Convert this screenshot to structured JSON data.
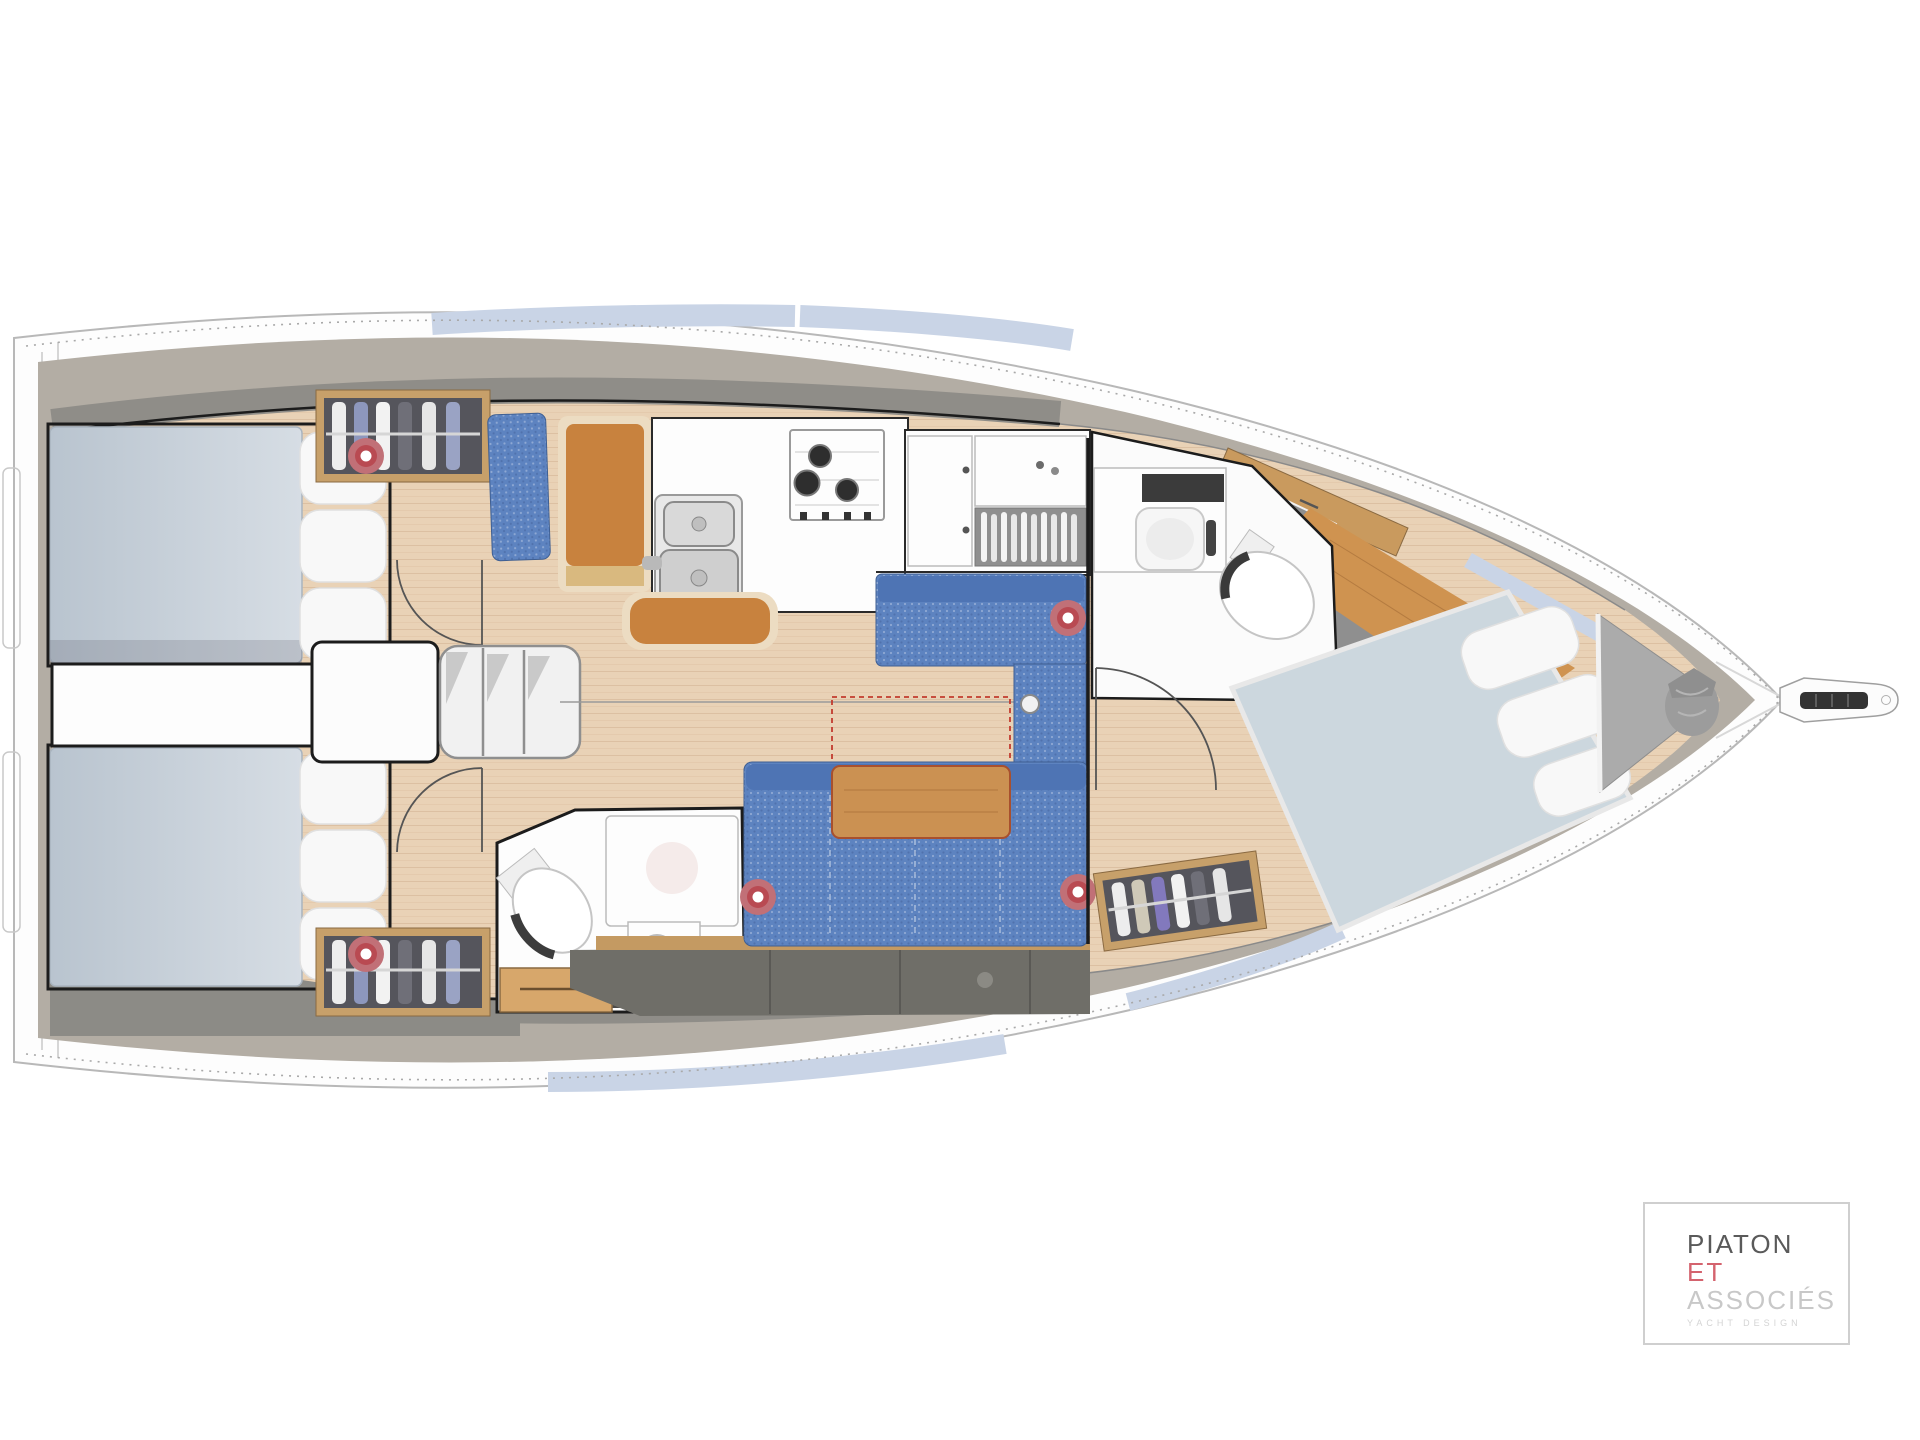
{
  "logo": {
    "name": "PIATON",
    "et": "ET",
    "associates": "ASSOCIÉS",
    "tagline": "YACHT DESIGN"
  },
  "colors": {
    "hull-stroke": "#b8b8b8",
    "deck-band": "#b3ada4",
    "deck-band-dark": "#8f8d88",
    "window-blue": "#c9d4e6",
    "wood-floor": "#e9d2b6",
    "wood-furniture": "#c8823e",
    "wood-trim": "#ecdcc2",
    "table-wood": "#cb9152",
    "fwd-mattress": "#ccd7de",
    "sofa-blue": "#5d83c0",
    "sofa-blue-dark": "#4e74b4",
    "locker-gray": "#6f6e68",
    "wardrobe-gray": "#55555c",
    "wardrobe-wood": "#c7a06a",
    "marker-red": "#b94a52",
    "line-black": "#1c1c1c",
    "anchor-gray": "#ababab",
    "logo-red": "#d4636e",
    "logo-gray": "#c8c8c8",
    "logo-dark": "#5a5a5a"
  },
  "plan": {
    "type": "sailing-yacht interior layout, top view, bow to the right",
    "features": [
      "aft double cabin port",
      "aft double cabin starboard",
      "companionway steps",
      "aft head with shower and toilet",
      "chart table with seat",
      "L-shaped galley with twin sinks and 3-burner stove",
      "saloon settees with folding table and dashed table-extension outline",
      "forward head with vanity and toilet",
      "forward owner cabin with angled island berth",
      "anchor locker with sail bag",
      "bow fitting with anchor roller"
    ],
    "deck_hatch_markers": 5
  }
}
